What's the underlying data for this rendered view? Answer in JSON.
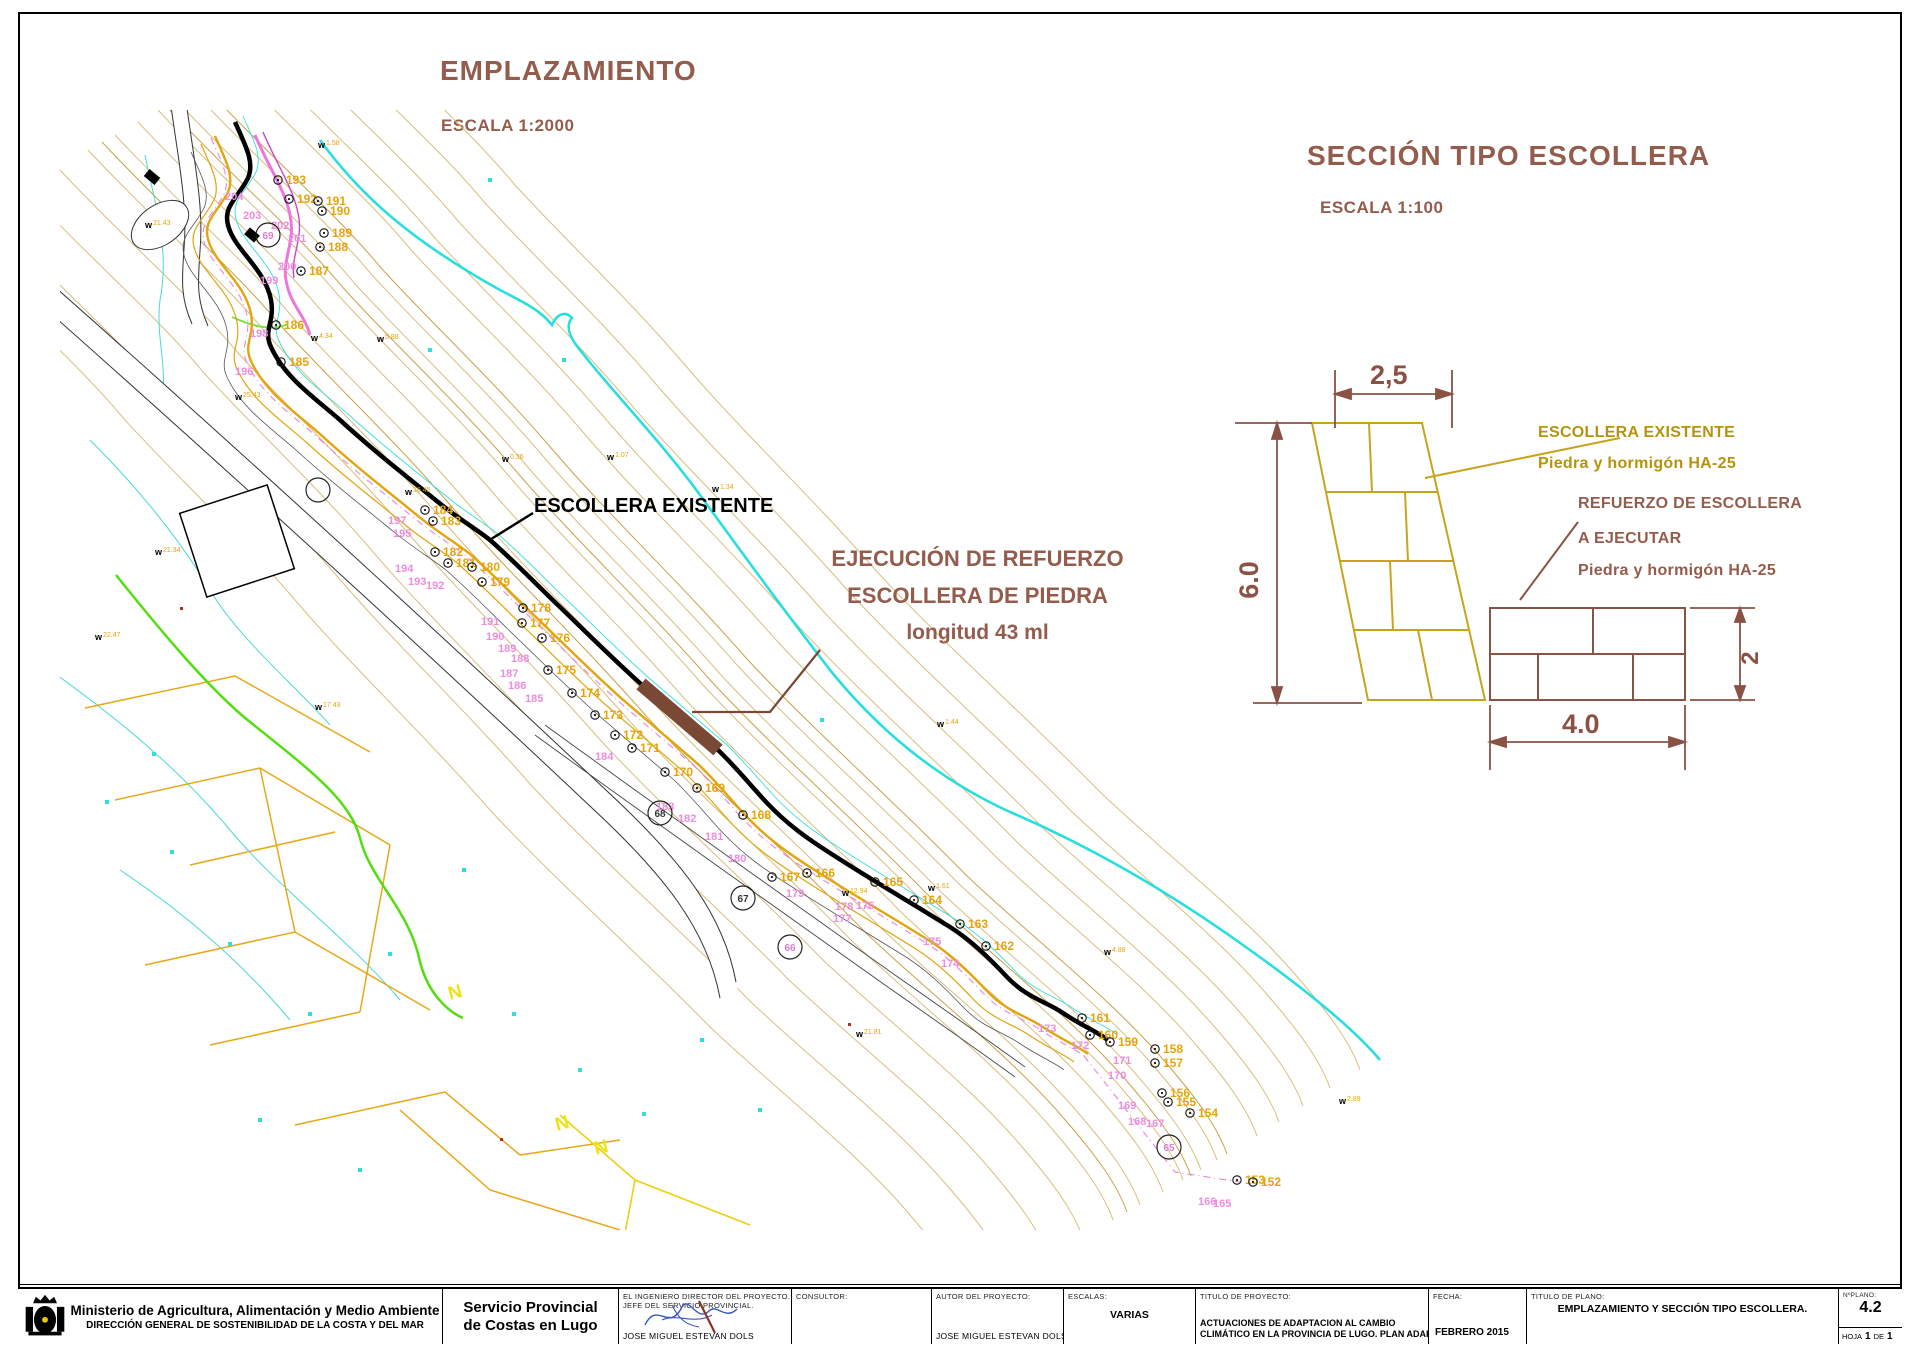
{
  "headings": {
    "emplazamiento": "EMPLAZAMIENTO",
    "emplazamiento_scale": "ESCALA 1:2000",
    "seccion": "SECCIÓN TIPO ESCOLLERA",
    "seccion_scale": "ESCALA 1:100"
  },
  "map": {
    "label_escollera_existente": "ESCOLLERA EXISTENTE",
    "callout_line1": "EJECUCIÓN DE REFUERZO",
    "callout_line2": "ESCOLLERA DE PIEDRA",
    "callout_line3": "longitud 43 ml",
    "survey_points": [
      {
        "n": "193",
        "x": 218,
        "y": 70
      },
      {
        "n": "192",
        "x": 229,
        "y": 89
      },
      {
        "n": "191",
        "x": 258,
        "y": 91
      },
      {
        "n": "190",
        "x": 262,
        "y": 101
      },
      {
        "n": "189",
        "x": 264,
        "y": 123
      },
      {
        "n": "188",
        "x": 260,
        "y": 137
      },
      {
        "n": "187",
        "x": 241,
        "y": 161
      },
      {
        "n": "186",
        "x": 216,
        "y": 215
      },
      {
        "n": "185",
        "x": 221,
        "y": 252
      },
      {
        "n": "184",
        "x": 365,
        "y": 400
      },
      {
        "n": "183",
        "x": 373,
        "y": 411
      },
      {
        "n": "182",
        "x": 375,
        "y": 442
      },
      {
        "n": "181",
        "x": 388,
        "y": 453
      },
      {
        "n": "180",
        "x": 412,
        "y": 457
      },
      {
        "n": "179",
        "x": 422,
        "y": 472
      },
      {
        "n": "178",
        "x": 463,
        "y": 498
      },
      {
        "n": "177",
        "x": 462,
        "y": 513
      },
      {
        "n": "176",
        "x": 482,
        "y": 528
      },
      {
        "n": "175",
        "x": 488,
        "y": 560
      },
      {
        "n": "174",
        "x": 512,
        "y": 583
      },
      {
        "n": "173",
        "x": 535,
        "y": 605
      },
      {
        "n": "172",
        "x": 555,
        "y": 625
      },
      {
        "n": "171",
        "x": 572,
        "y": 638
      },
      {
        "n": "170",
        "x": 605,
        "y": 662
      },
      {
        "n": "169",
        "x": 637,
        "y": 678
      },
      {
        "n": "168",
        "x": 683,
        "y": 705
      },
      {
        "n": "167",
        "x": 712,
        "y": 767
      },
      {
        "n": "166",
        "x": 747,
        "y": 763
      },
      {
        "n": "165",
        "x": 815,
        "y": 772
      },
      {
        "n": "164",
        "x": 854,
        "y": 790
      },
      {
        "n": "163",
        "x": 900,
        "y": 814
      },
      {
        "n": "162",
        "x": 926,
        "y": 836
      },
      {
        "n": "161",
        "x": 1022,
        "y": 908
      },
      {
        "n": "160",
        "x": 1030,
        "y": 925
      },
      {
        "n": "159",
        "x": 1050,
        "y": 932
      },
      {
        "n": "158",
        "x": 1095,
        "y": 939
      },
      {
        "n": "157",
        "x": 1095,
        "y": 953
      },
      {
        "n": "156",
        "x": 1102,
        "y": 983
      },
      {
        "n": "155",
        "x": 1108,
        "y": 992
      },
      {
        "n": "154",
        "x": 1130,
        "y": 1003
      },
      {
        "n": "153",
        "x": 1177,
        "y": 1070
      },
      {
        "n": "152",
        "x": 1193,
        "y": 1072
      }
    ],
    "profile_points": [
      {
        "n": "204",
        "x": 187,
        "y": 78
      },
      {
        "n": "203",
        "x": 205,
        "y": 97
      },
      {
        "n": "202",
        "x": 233,
        "y": 107
      },
      {
        "n": "201",
        "x": 250,
        "y": 120
      },
      {
        "n": "200",
        "x": 240,
        "y": 148
      },
      {
        "n": "199",
        "x": 222,
        "y": 162
      },
      {
        "n": "198",
        "x": 212,
        "y": 215
      },
      {
        "n": "197",
        "x": 350,
        "y": 402
      },
      {
        "n": "196",
        "x": 197,
        "y": 253
      },
      {
        "n": "195",
        "x": 355,
        "y": 415
      },
      {
        "n": "194",
        "x": 357,
        "y": 450
      },
      {
        "n": "193",
        "x": 370,
        "y": 463
      },
      {
        "n": "192",
        "x": 388,
        "y": 467
      },
      {
        "n": "191",
        "x": 443,
        "y": 503
      },
      {
        "n": "190",
        "x": 448,
        "y": 518
      },
      {
        "n": "189",
        "x": 460,
        "y": 530
      },
      {
        "n": "188",
        "x": 473,
        "y": 540
      },
      {
        "n": "187",
        "x": 462,
        "y": 555
      },
      {
        "n": "186",
        "x": 470,
        "y": 567
      },
      {
        "n": "185",
        "x": 487,
        "y": 580
      },
      {
        "n": "184",
        "x": 557,
        "y": 638
      },
      {
        "n": "183",
        "x": 618,
        "y": 688
      },
      {
        "n": "182",
        "x": 640,
        "y": 700
      },
      {
        "n": "181",
        "x": 667,
        "y": 718
      },
      {
        "n": "180",
        "x": 690,
        "y": 740
      },
      {
        "n": "179",
        "x": 748,
        "y": 775
      },
      {
        "n": "178",
        "x": 797,
        "y": 788
      },
      {
        "n": "177",
        "x": 795,
        "y": 800
      },
      {
        "n": "176",
        "x": 818,
        "y": 787
      },
      {
        "n": "175",
        "x": 885,
        "y": 823
      },
      {
        "n": "174",
        "x": 903,
        "y": 845
      },
      {
        "n": "173",
        "x": 1000,
        "y": 910
      },
      {
        "n": "172",
        "x": 1033,
        "y": 927
      },
      {
        "n": "171",
        "x": 1075,
        "y": 942
      },
      {
        "n": "170",
        "x": 1070,
        "y": 957
      },
      {
        "n": "169",
        "x": 1080,
        "y": 987
      },
      {
        "n": "168",
        "x": 1090,
        "y": 1003
      },
      {
        "n": "167",
        "x": 1108,
        "y": 1005
      },
      {
        "n": "166",
        "x": 1160,
        "y": 1083
      },
      {
        "n": "165",
        "x": 1175,
        "y": 1085
      }
    ],
    "circled_points": [
      {
        "n": "69",
        "x": 208,
        "y": 125,
        "c": "#d981cc"
      },
      {
        "n": "68",
        "x": 600,
        "y": 703,
        "c": "#333333"
      },
      {
        "n": "67",
        "x": 683,
        "y": 788,
        "c": "#333333"
      },
      {
        "n": "66",
        "x": 730,
        "y": 837,
        "c": "#d981cc"
      },
      {
        "n": "65",
        "x": 1109,
        "y": 1037,
        "c": "#d981cc"
      },
      {
        "n": "",
        "x": 258,
        "y": 380,
        "c": "#333333"
      }
    ],
    "w_marks": [
      {
        "x": 85,
        "y": 118,
        "v": "21.43"
      },
      {
        "x": 175,
        "y": 290,
        "v": "25.43"
      },
      {
        "x": 95,
        "y": 445,
        "v": "21.34"
      },
      {
        "x": 35,
        "y": 530,
        "v": "22.47"
      },
      {
        "x": 255,
        "y": 600,
        "v": "17.43"
      },
      {
        "x": 345,
        "y": 385,
        "v": "16.45"
      },
      {
        "x": 442,
        "y": 352,
        "v": "0.36"
      },
      {
        "x": 547,
        "y": 350,
        "v": "1.07"
      },
      {
        "x": 652,
        "y": 382,
        "v": "1.34"
      },
      {
        "x": 877,
        "y": 617,
        "v": "1.44"
      },
      {
        "x": 251,
        "y": 231,
        "v": "4.34"
      },
      {
        "x": 317,
        "y": 232,
        "v": "5.88"
      },
      {
        "x": 868,
        "y": 781,
        "v": "1.61"
      },
      {
        "x": 1044,
        "y": 845,
        "v": "4.88"
      },
      {
        "x": 782,
        "y": 786,
        "v": "12.94"
      },
      {
        "x": 796,
        "y": 927,
        "v": "21.81"
      },
      {
        "x": 1279,
        "y": 994,
        "v": "2.89"
      },
      {
        "x": 258,
        "y": 38,
        "v": "1.58"
      }
    ],
    "n_marks": [
      {
        "x": 390,
        "y": 890
      },
      {
        "x": 497,
        "y": 1021
      },
      {
        "x": 536,
        "y": 1045
      }
    ],
    "dots_cyan": [
      [
        45,
        690
      ],
      [
        110,
        740
      ],
      [
        168,
        832
      ],
      [
        248,
        902
      ],
      [
        328,
        842
      ],
      [
        402,
        758
      ],
      [
        452,
        902
      ],
      [
        518,
        958
      ],
      [
        582,
        1002
      ],
      [
        640,
        928
      ],
      [
        698,
        998
      ],
      [
        298,
        1058
      ],
      [
        198,
        1008
      ],
      [
        92,
        642
      ],
      [
        502,
        248
      ],
      [
        428,
        68
      ],
      [
        368,
        238
      ],
      [
        760,
        608
      ]
    ],
    "dots_red": [
      [
        120,
        497
      ],
      [
        788,
        913
      ],
      [
        440,
        1028
      ]
    ],
    "colors": {
      "coast": "#2adede",
      "contour": "#d8bf7d",
      "orange": "#e2a50e",
      "escollera": "#000000",
      "refuerzo": "#7a4936",
      "profile": "#ee82d9",
      "green": "#55dd11"
    }
  },
  "section": {
    "dim_width_top": "2,5",
    "dim_height": "6.0",
    "dim_width_bottom": "4.0",
    "dim_height_small": "2",
    "label_existente_1": "ESCOLLERA EXISTENTE",
    "label_existente_2": "Piedra y hormigón HA-25",
    "label_refuerzo_1": "REFUERZO DE ESCOLLERA",
    "label_refuerzo_2": "A EJECUTAR",
    "label_refuerzo_3": "Piedra y hormigón HA-25"
  },
  "titleblock": {
    "ministry_line1": "Ministerio de Agricultura, Alimentación y Medio Ambiente",
    "ministry_line2": "DIRECCIÓN GENERAL DE SOSTENIBILIDAD DE LA COSTA Y DEL MAR",
    "servicio_line1": "Servicio Provincial",
    "servicio_line2": "de Costas en Lugo",
    "engineer_label1": "EL INGENIERO DIRECTOR DEL PROYECTO.",
    "engineer_label2": "JEFE DEL SERVICIO PROVINCIAL.",
    "engineer_name": "JOSE MIGUEL ESTEVAN DOLS",
    "consultor_label": "CONSULTOR:",
    "autor_label": "AUTOR DEL PROYECTO:",
    "autor_name": "JOSE MIGUEL ESTEVAN DOLS",
    "escalas_label": "ESCALAS:",
    "escalas_value": "VARIAS",
    "titulo_proyecto_label": "TITULO DE PROYECTO:",
    "titulo_proyecto_line1": "ACTUACIONES DE ADAPTACION AL CAMBIO",
    "titulo_proyecto_line2": "CLIMÁTICO EN LA PROVINCIA DE LUGO. PLAN ADAPTA.",
    "fecha_label": "FECHA:",
    "fecha_value": "FEBRERO 2015",
    "titulo_plano_label": "TITULO DE PLANO:",
    "titulo_plano_value": "EMPLAZAMIENTO Y SECCIÓN TIPO ESCOLLERA.",
    "plano_num_label": "NºPLANO:",
    "plano_num": "4.2",
    "hoja_label": "HOJA",
    "hoja_num": "1",
    "de_label": "DE",
    "hoja_total": "1"
  }
}
